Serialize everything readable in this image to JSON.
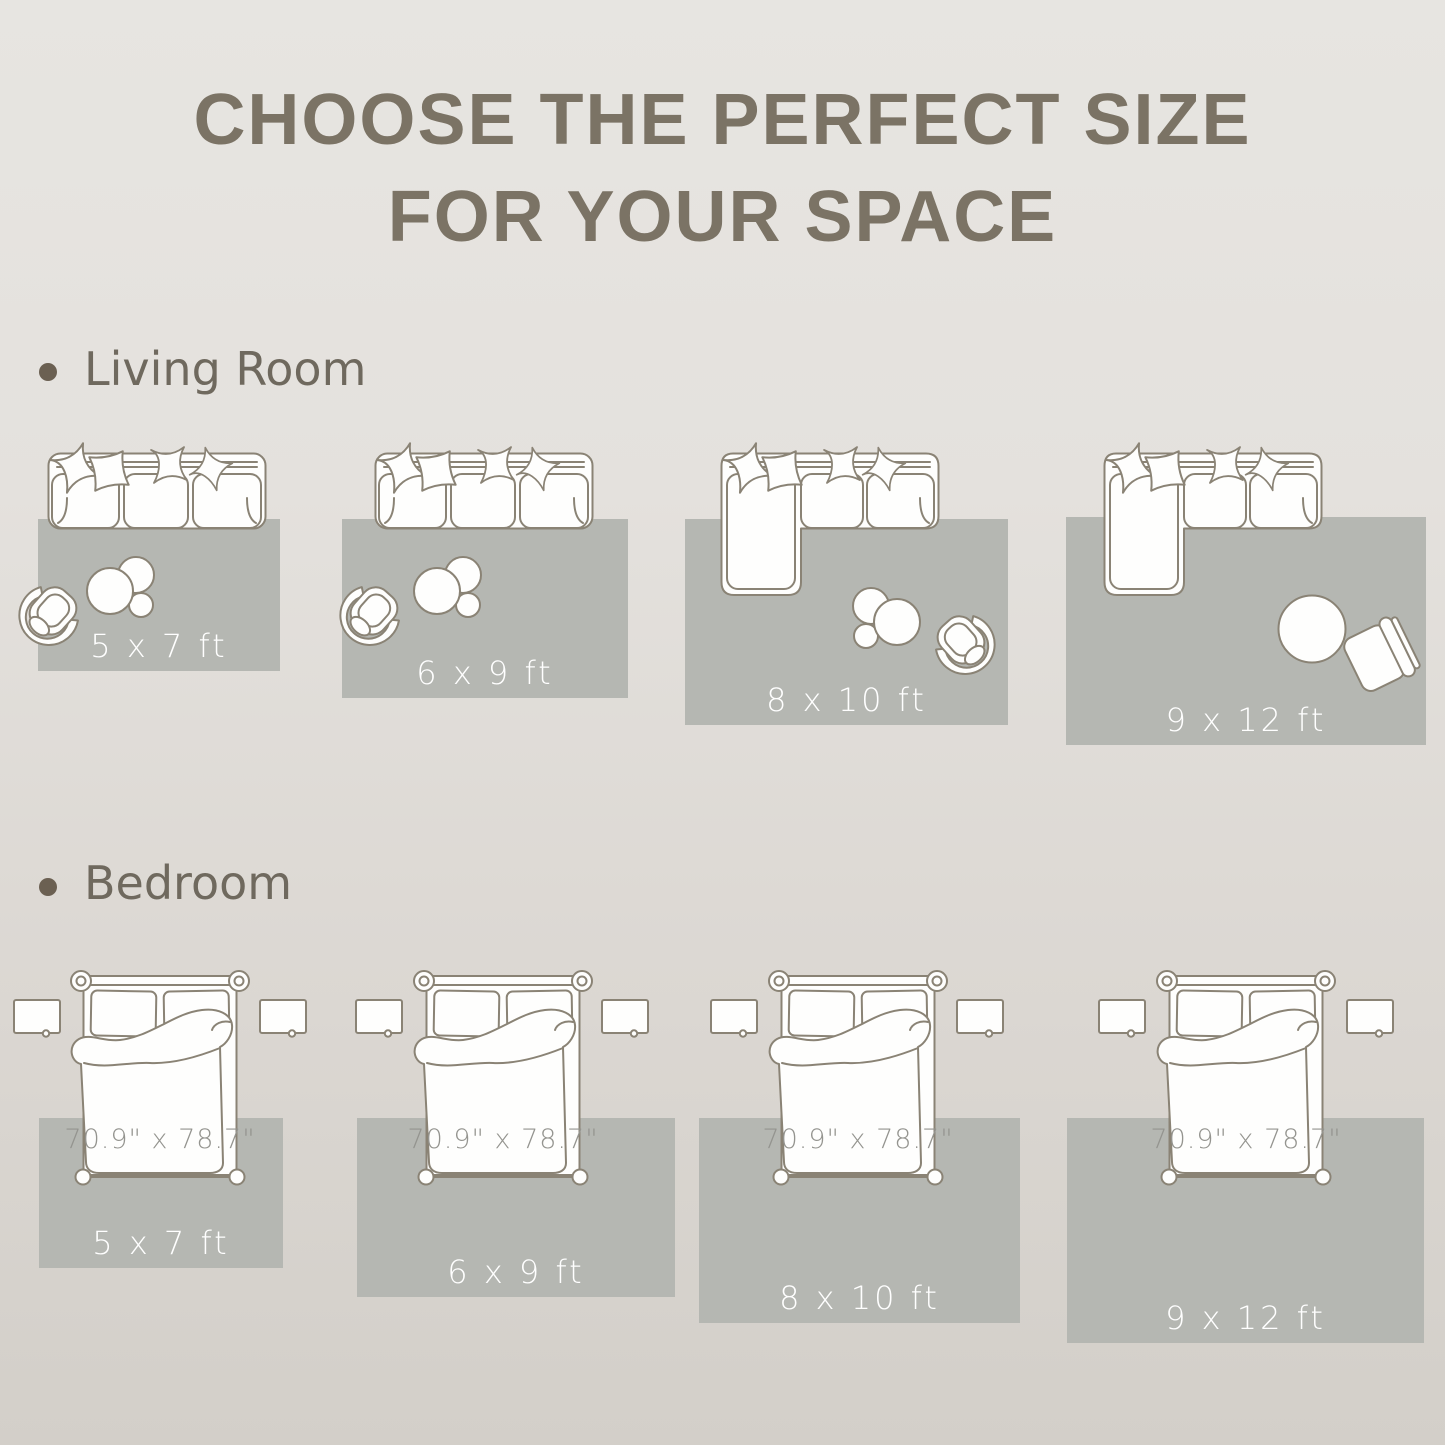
{
  "title": {
    "line1": "CHOOSE THE PERFECT SIZE",
    "line2": "FOR YOUR SPACE"
  },
  "sections": [
    {
      "label": "Living Room",
      "rugs": [
        {
          "size": "5 x 7 ft"
        },
        {
          "size": "6 x 9 ft"
        },
        {
          "size": "8 x 10 ft"
        },
        {
          "size": "9 x 12 ft"
        }
      ]
    },
    {
      "label": "Bedroom",
      "bed_size": "70.9\" x 78.7\"",
      "rugs": [
        {
          "size": "5 x 7 ft"
        },
        {
          "size": "6 x 9 ft"
        },
        {
          "size": "8 x 10 ft"
        },
        {
          "size": "9 x 12 ft"
        }
      ]
    }
  ],
  "colors": {
    "background_top": "#e7e5e1",
    "background_bottom": "#d3cfc9",
    "rug": "#b5b7b2",
    "outline": "#8a8375",
    "title_text": "#7b7365",
    "label_text": "#6f695e",
    "bullet": "#6b6052",
    "rug_label_text": "#ffffff",
    "bed_size_text": "#94948f"
  }
}
